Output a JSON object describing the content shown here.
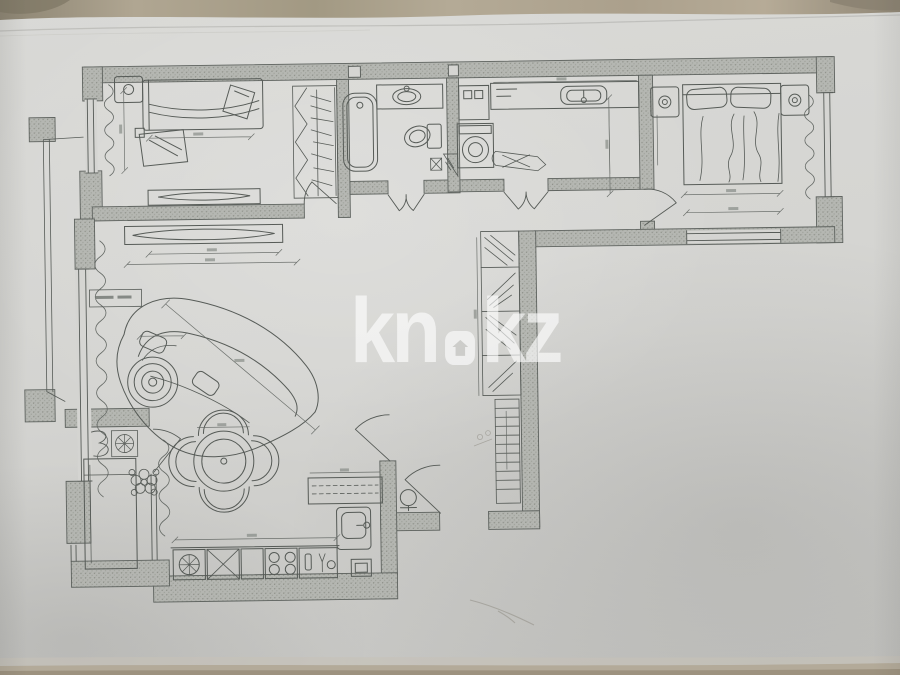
{
  "photo": {
    "paper_color": "#d5d5d2",
    "table_strip_color": "#a89d8b",
    "ink_color": "#4d524e",
    "wall_fill_color": "#b3b5b0"
  },
  "watermark": {
    "left": "kn",
    "right": "kz",
    "separator_icon": "home-pin-icon",
    "color": "#ffffff",
    "opacity": 0.62
  },
  "floor_plan": {
    "type": "apartment-floor-plan",
    "legible_labels": [],
    "rooms": [
      {
        "id": "bedroom-1",
        "features": [
          "single-bed",
          "nightstand",
          "desk-mirror",
          "wardrobe",
          "window",
          "dresser"
        ]
      },
      {
        "id": "bathroom",
        "features": [
          "bathtub",
          "vanity-sink",
          "toilet",
          "corner-shelf"
        ]
      },
      {
        "id": "laundry-room",
        "features": [
          "washing-machine",
          "cabinet",
          "counter-sink",
          "ironing-board"
        ]
      },
      {
        "id": "bedroom-2",
        "features": [
          "double-bed",
          "two-nightstands",
          "window",
          "curtain"
        ]
      },
      {
        "id": "living-room",
        "features": [
          "curved-sofa",
          "tv-stand",
          "round-side-table",
          "plant",
          "window",
          "curtain"
        ]
      },
      {
        "id": "hallway",
        "features": [
          "closet-sections",
          "shoe-rack",
          "pouf",
          "entrance-door"
        ]
      },
      {
        "id": "kitchen",
        "features": [
          "round-dining-table",
          "four-chairs",
          "stove",
          "sink",
          "counter-row",
          "balcony-door"
        ]
      },
      {
        "id": "balcony",
        "features": [
          "bench",
          "small-sink",
          "fan-square"
        ]
      }
    ]
  }
}
